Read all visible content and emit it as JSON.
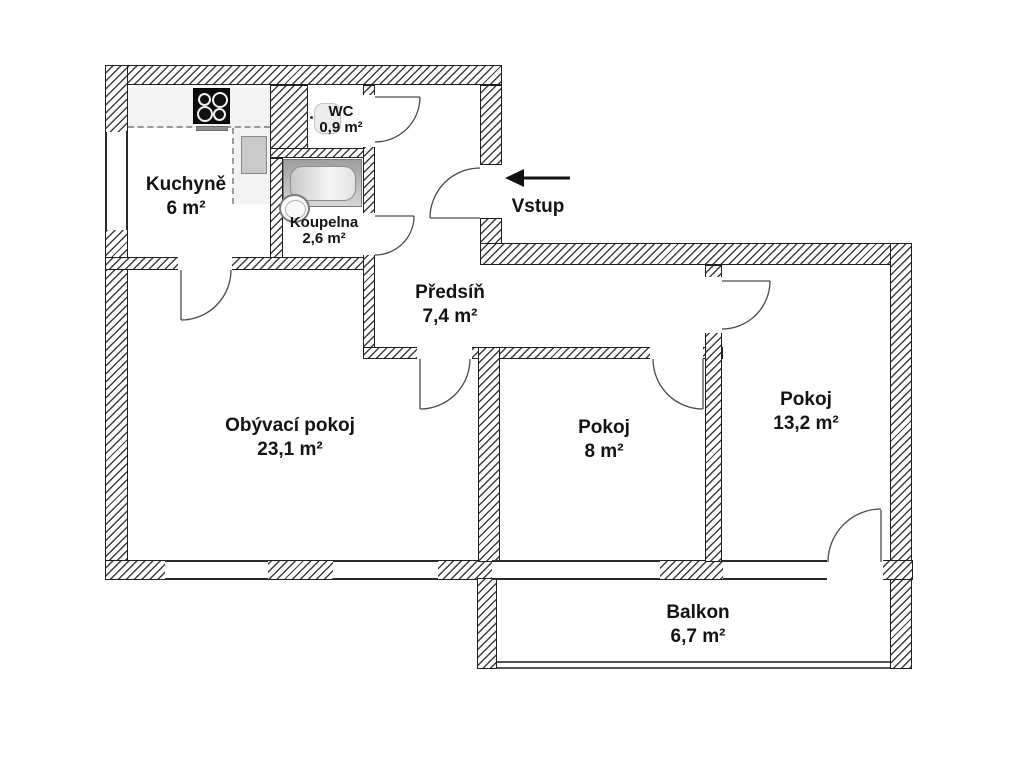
{
  "floorplan": {
    "title": "Apartment floor plan",
    "entrance_label": "Vstup",
    "rooms": [
      {
        "id": "kuchyne",
        "name": "Kuchyně",
        "area": "6 m²"
      },
      {
        "id": "wc",
        "name": "WC",
        "area": "0,9 m²"
      },
      {
        "id": "koupelna",
        "name": "Koupelna",
        "area": "2,6 m²"
      },
      {
        "id": "predsin",
        "name": "Předsíň",
        "area": "7,4 m²"
      },
      {
        "id": "obyvaci-pokoj",
        "name": "Obývací pokoj",
        "area": "23,1 m²"
      },
      {
        "id": "pokoj-8",
        "name": "Pokoj",
        "area": "8 m²"
      },
      {
        "id": "pokoj-13",
        "name": "Pokoj",
        "area": "13,2 m²"
      },
      {
        "id": "balkon",
        "name": "Balkon",
        "area": "6,7 m²"
      }
    ],
    "colors": {
      "wall_hatch": "#3d3d3d",
      "outline": "#1f1f1f",
      "fixture_gray": "#c9c9c9",
      "text": "#141414"
    }
  }
}
